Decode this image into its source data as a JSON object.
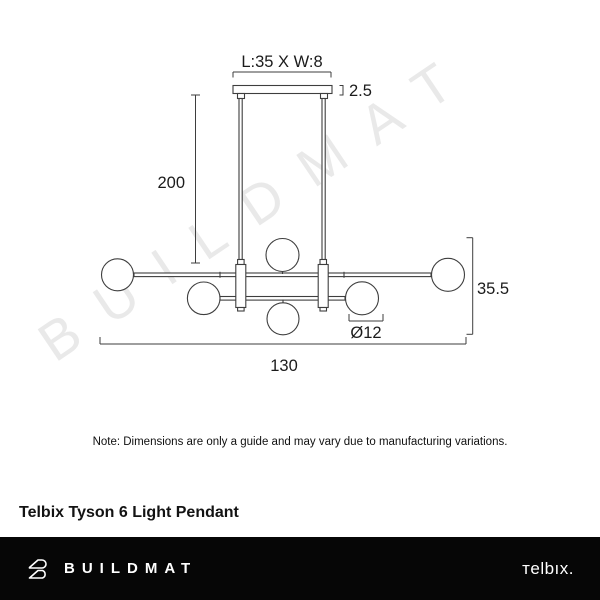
{
  "watermark": {
    "text": "BUILDMAT",
    "color": "#e9e9e9"
  },
  "diagram": {
    "line_color": "#3e3e3e",
    "labels": {
      "canopy_size": "L:35 X W:8",
      "canopy_height": "2.5",
      "drop_length": "200",
      "fixture_height": "35.5",
      "globe_diameter": "Ø12",
      "fixture_width": "130"
    }
  },
  "note": "Note: Dimensions are only a guide and may vary due to manufacturing variations.",
  "product_title": "Telbix Tyson 6 Light Pendant",
  "footer": {
    "brand": "BUILDMAT",
    "partner_brand": "тelbıx.",
    "background": "#060606"
  }
}
